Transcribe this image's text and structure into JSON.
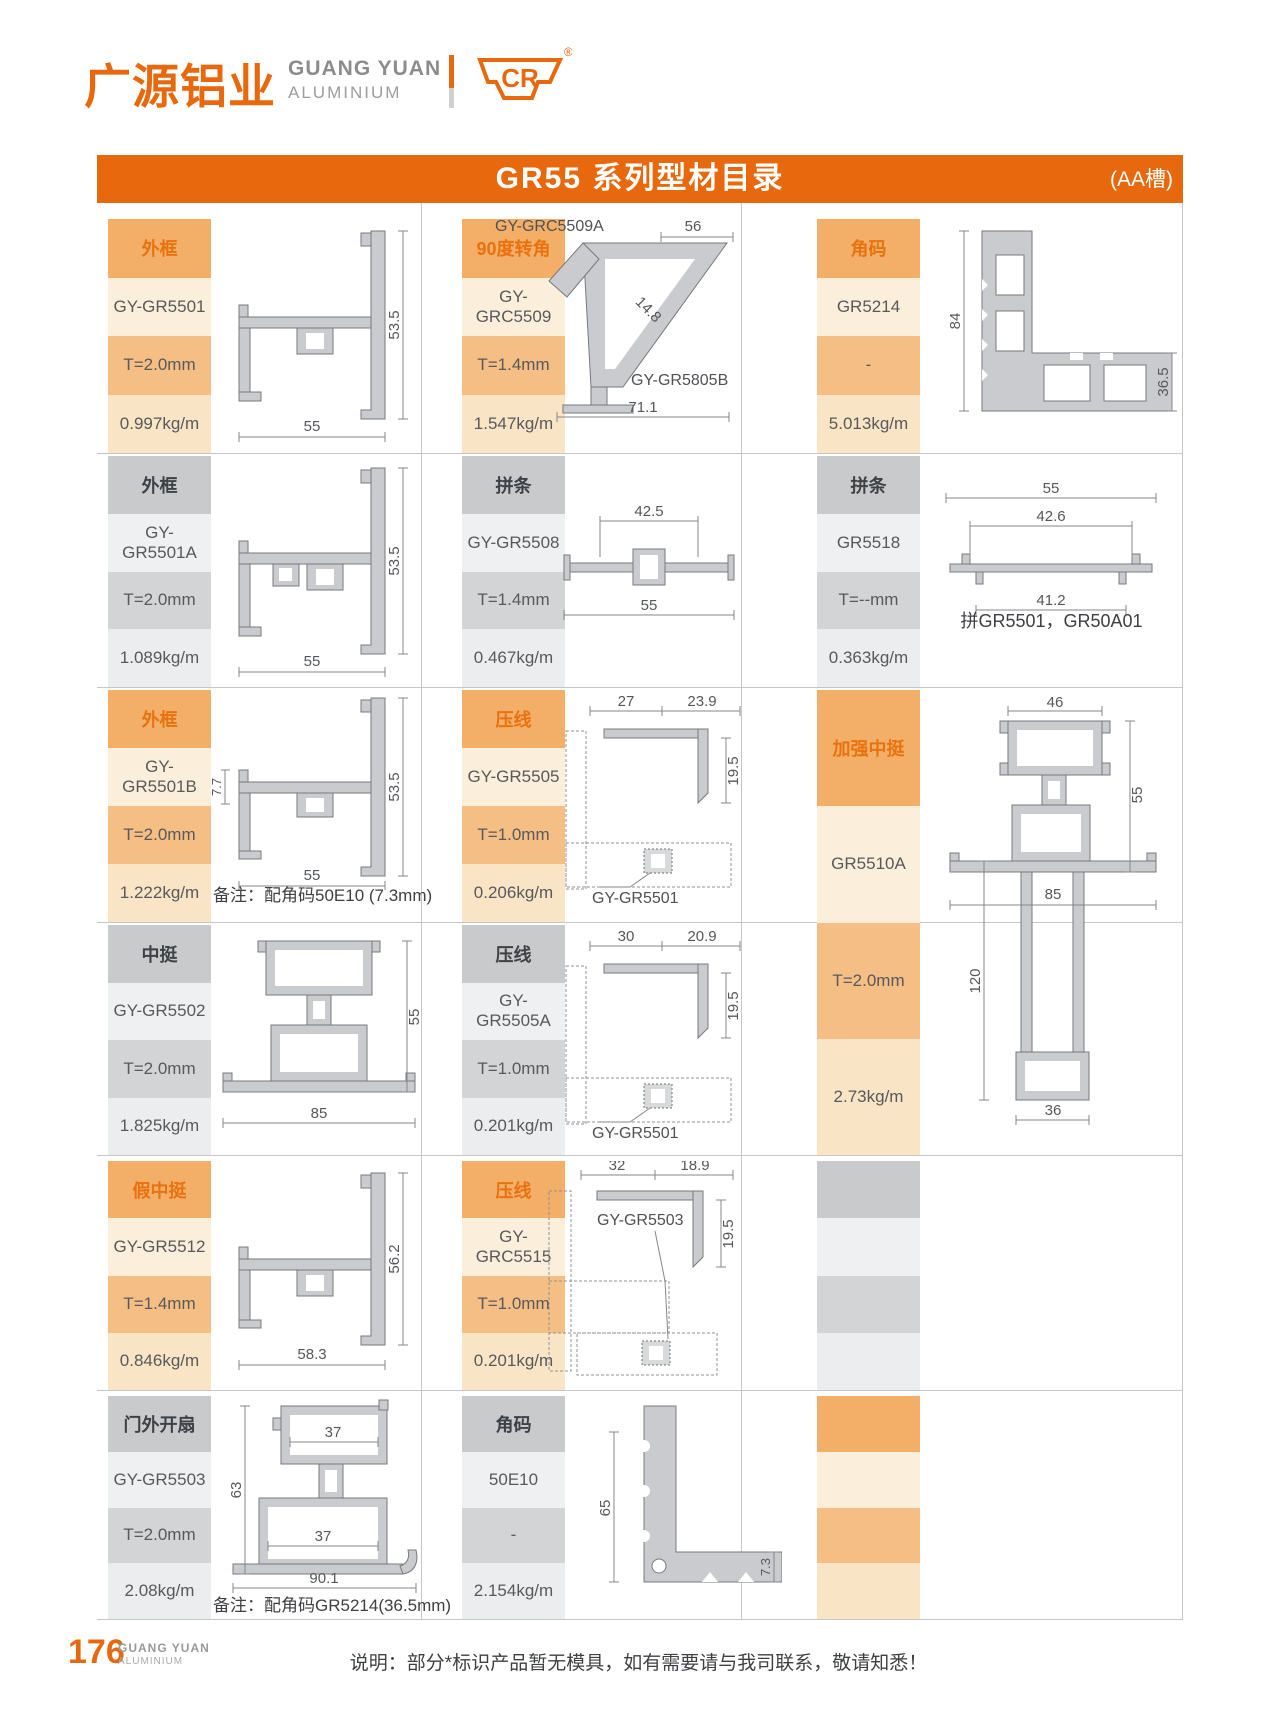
{
  "brand": {
    "cn": "广源铝业",
    "en_top": "GUANG YUAN",
    "en_bottom": "ALUMINIUM",
    "mark": "CR",
    "registered": "®"
  },
  "header": {
    "title": "GR55 系列型材目录",
    "tag": "(AA槽)"
  },
  "colors": {
    "orange": "#E8680E",
    "orange_cell": "#F3AE68",
    "orange_light": "#FBEEDB",
    "orange_mid": "#F5BE85",
    "gray_cell": "#C8CACC",
    "gray_light": "#EFF0F1",
    "profile_fill": "#C9CBCE"
  },
  "cells": {
    "r1u1": {
      "type": "外框",
      "code": "GY-GR5501",
      "thickness": "T=2.0mm",
      "weight": "0.997kg/m"
    },
    "r1u2": {
      "type": "90度转角",
      "code": "GY-GRC5509",
      "thickness": "T=1.4mm",
      "weight": "1.547kg/m"
    },
    "r1u3": {
      "type": "角码",
      "code": "GR5214",
      "thickness": "-",
      "weight": "5.013kg/m"
    },
    "r2u1": {
      "type": "外框",
      "code": "GY-GR5501A",
      "thickness": "T=2.0mm",
      "weight": "1.089kg/m"
    },
    "r2u2": {
      "type": "拼条",
      "code": "GY-GR5508",
      "thickness": "T=1.4mm",
      "weight": "0.467kg/m"
    },
    "r2u3": {
      "type": "拼条",
      "code": "GR5518",
      "thickness": "T=--mm",
      "weight": "0.363kg/m"
    },
    "r3u1": {
      "type": "外框",
      "code": "GY-GR5501B",
      "thickness": "T=2.0mm",
      "weight": "1.222kg/m"
    },
    "r3u2": {
      "type": "压线",
      "code": "GY-GR5505",
      "thickness": "T=1.0mm",
      "weight": "0.206kg/m"
    },
    "r34u3": {
      "type": "加强中挺",
      "code": "GR5510A",
      "thickness": "T=2.0mm",
      "weight": "2.73kg/m"
    },
    "r4u1": {
      "type": "中挺",
      "code": "GY-GR5502",
      "thickness": "T=2.0mm",
      "weight": "1.825kg/m"
    },
    "r4u2": {
      "type": "压线",
      "code": "GY-GR5505A",
      "thickness": "T=1.0mm",
      "weight": "0.201kg/m"
    },
    "r5u1": {
      "type": "假中挺",
      "code": "GY-GR5512",
      "thickness": "T=1.4mm",
      "weight": "0.846kg/m"
    },
    "r5u2": {
      "type": "压线",
      "code": "GY-GRC5515",
      "thickness": "T=1.0mm",
      "weight": "0.201kg/m"
    },
    "r6u1": {
      "type": "门外开扇",
      "code": "GY-GR5503",
      "thickness": "T=2.0mm",
      "weight": "2.08kg/m"
    },
    "r6u2": {
      "type": "角码",
      "code": "50E10",
      "thickness": "-",
      "weight": "2.154kg/m"
    }
  },
  "diagrams": {
    "r1u1": {
      "width": "55",
      "height": "53.5"
    },
    "r1u2": {
      "top_label": "GY-GRC5509A",
      "top": "56",
      "diagonal": "14.8",
      "bottom_label": "GY-GR5805B",
      "bottom": "71.1"
    },
    "r1u3": {
      "left": "84",
      "right": "36.5"
    },
    "r2u1": {
      "width": "55",
      "height": "53.5"
    },
    "r2u2": {
      "top": "42.5",
      "bottom": "55"
    },
    "r2u3": {
      "top": "55",
      "middle": "42.6",
      "bottom": "41.2"
    },
    "r3u1": {
      "left": "7.7",
      "height": "53.5",
      "width": "55"
    },
    "r3u2": {
      "dim1": "27",
      "dim2": "23.9",
      "side": "19.5",
      "ref": "GY-GR5501"
    },
    "r34u3": {
      "top": "46",
      "right": "55",
      "left": "120",
      "middle": "85",
      "bottom": "36"
    },
    "r4u1": {
      "height": "55",
      "width": "85"
    },
    "r4u2": {
      "dim1": "30",
      "dim2": "20.9",
      "side": "19.5",
      "ref": "GY-GR5501"
    },
    "r5u1": {
      "height": "56.2",
      "width": "58.3"
    },
    "r5u2": {
      "dim1": "32",
      "dim2": "18.9",
      "side": "19.5",
      "ref": "GY-GR5503"
    },
    "r6u1": {
      "top": "37",
      "left": "63",
      "middle": "37",
      "bottom": "90.1"
    },
    "r6u2": {
      "left": "65",
      "right": "7.3"
    }
  },
  "notes": {
    "r2u3": "拼GR5501，GR50A01",
    "r3u1": "备注：配角码50E10 (7.3mm)",
    "r6u1": "备注：配角码GR5214(36.5mm)"
  },
  "footer": {
    "page": "176",
    "brand_top": "GUANG YUAN",
    "brand_bottom": "ALUMINIUM",
    "note": "说明：部分*标识产品暂无模具，如有需要请与我司联系，敬请知悉！"
  }
}
